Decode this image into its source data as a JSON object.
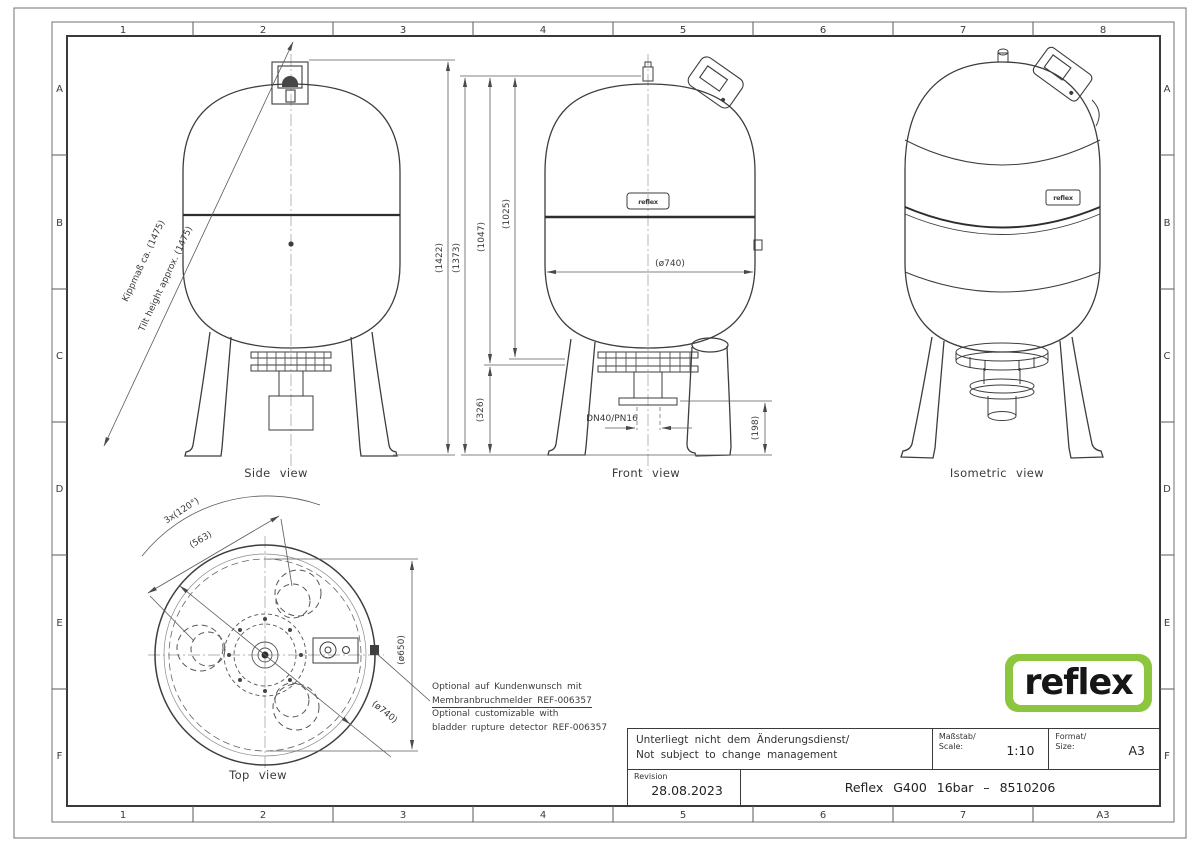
{
  "sheet": {
    "cols_top": [
      "1",
      "2",
      "3",
      "4",
      "5",
      "6",
      "7",
      "8"
    ],
    "cols_bottom": [
      "1",
      "2",
      "3",
      "4",
      "5",
      "6",
      "7",
      "A3"
    ],
    "rows_left": [
      "A",
      "B",
      "C",
      "D",
      "E",
      "F"
    ],
    "rows_right": [
      "A",
      "B",
      "C",
      "D",
      "E",
      "F"
    ]
  },
  "views": {
    "side": {
      "caption": "Side view",
      "dim_height": "(1422)",
      "tilt_label_de": "Kippmaß ca. (1475)",
      "tilt_label_en": "Tilt height approx. (1475)"
    },
    "front": {
      "caption": "Front view",
      "dim_total": "(1373)",
      "dim_upper": "(1047)",
      "dim_body": "(1025)",
      "dim_legs": "(326)",
      "dim_diameter": "(ø740)",
      "connection": "DN40/PN16",
      "dim_clearance": "(198)",
      "nameplate": "reflex"
    },
    "isometric": {
      "caption": "Isometric view",
      "nameplate": "reflex"
    },
    "top": {
      "caption": "Top view",
      "dim_legs_angle": "3x(120°)",
      "dim_leg_pitch": "(563)",
      "dim_inner": "(ø650)",
      "dim_outer": "(ø740)"
    }
  },
  "note": {
    "line1": "Optional auf Kundenwunsch mit",
    "line2": "Membranbruchmelder REF-006357",
    "line3": "Optional customizable with",
    "line4": "bladder rupture detector REF-006357"
  },
  "logo": {
    "text": "reflex",
    "color": "#8CC63F"
  },
  "title_block": {
    "change_de": "Unterliegt nicht dem Änderungsdienst/",
    "change_en": "Not subject to change management",
    "scale_label_de": "Maßstab/",
    "scale_label_en": "Scale:",
    "scale_value": "1:10",
    "format_label_de": "Format/",
    "format_label_en": "Size:",
    "format_value": "A3",
    "revision_label": "Revision",
    "revision_date": "28.08.2023",
    "drawing_title": "Reflex G400 16bar – 8510206"
  }
}
